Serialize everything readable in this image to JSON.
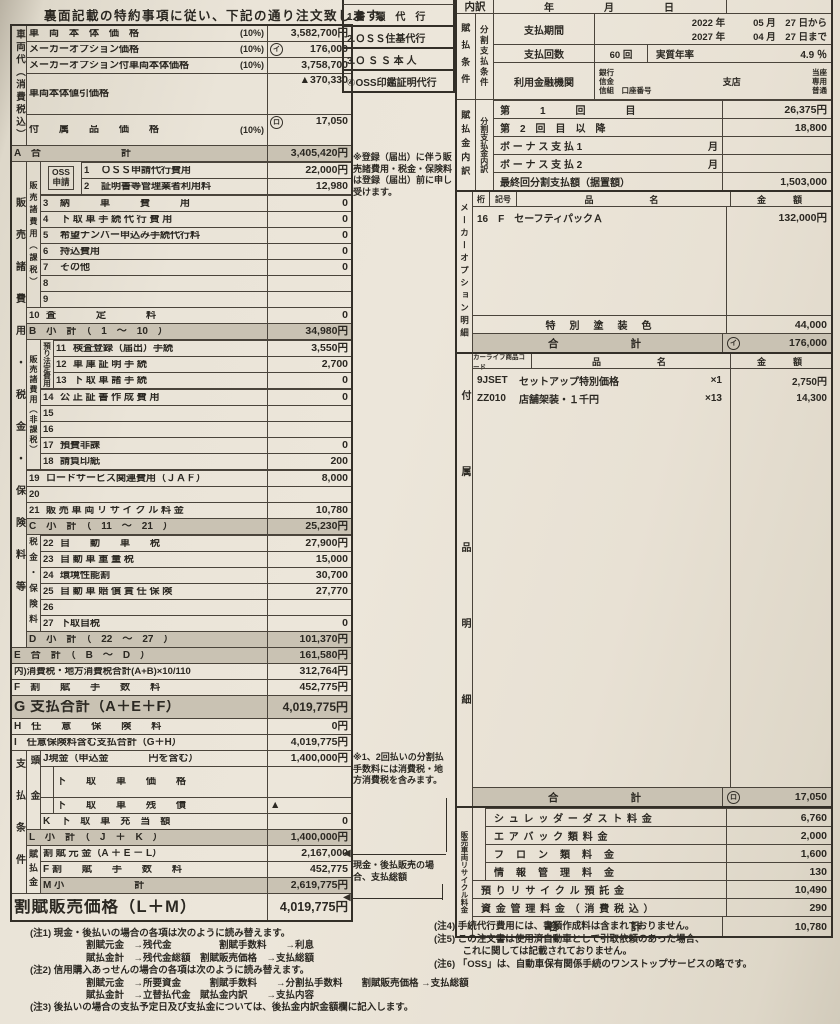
{
  "page": {
    "header_note": "裏面記載の特約事項に従い、下記の通り注文致します。"
  },
  "left": {
    "strip_vehicle": "車両代（消費税込）",
    "strip_sales": "販売諸費用・税金・保険料等",
    "strip_payment": "支払条件",
    "vehicle": {
      "r1": {
        "label": "車　両　本　体　価　格",
        "pct": "(10%)",
        "value": "3,582,700円"
      },
      "r2": {
        "label": "メーカーオプション価格",
        "pct": "(10%)",
        "mark": "イ",
        "value": "176,000"
      },
      "r3": {
        "label": "メーカーオプション付車両本体価格",
        "pct": "(10%)",
        "value": "3,758,700"
      },
      "r4": {
        "label": "車両本体値引価格",
        "value": "▲370,330"
      },
      "r5": {
        "label": "付　　属　　品　　価　　格",
        "pct": "(10%)",
        "mark": "ロ",
        "value": "17,050"
      }
    },
    "subA": {
      "label": "A　合　　　　　　　　計",
      "value": "3,405,420円"
    },
    "oss_box": "OSS\n申請",
    "strip_taxable": "販売諸費用（課税）",
    "oss_rows": [
      {
        "num": "1",
        "label": "ＯＳＳ申請代行費用",
        "value": "22,000円"
      },
      {
        "num": "2",
        "label": "証明書等管理業者利用料",
        "value": "12,980"
      }
    ],
    "taxable_rows": [
      {
        "num": "3",
        "label": "納　　　車　　　費　　　用",
        "value": "0"
      },
      {
        "num": "4",
        "label": "下 取 車 手 続 代 行 費 用",
        "value": "0"
      },
      {
        "num": "5",
        "label": "希望ナンバー申込み手続代行料",
        "value": "0"
      },
      {
        "num": "6",
        "label": "持込費用",
        "value": "0"
      },
      {
        "num": "7",
        "label": "その他",
        "value": "0"
      },
      {
        "num": "8",
        "label": "",
        "value": ""
      },
      {
        "num": "9",
        "label": "",
        "value": ""
      }
    ],
    "row10": {
      "num": "10",
      "label": "査　　　　定　　　　料",
      "value": "0"
    },
    "subB": {
      "label": "B　小　計　（　1　～　10　）",
      "value": "34,980円"
    },
    "strip_nontax": "販売諸費用（非課税）",
    "strip_deposit": "預り法定費用",
    "deposit_rows": [
      {
        "num": "11",
        "label": "検査登録（届出）手続",
        "value": "3,550円"
      },
      {
        "num": "12",
        "label": "車 庫 証 明 手 続",
        "value": "2,700"
      },
      {
        "num": "13",
        "label": "下 取 車 諸 手 続",
        "value": "0"
      }
    ],
    "nontax_rows": [
      {
        "num": "14",
        "label": "公 正 証 書 作 成 費 用",
        "value": "0"
      },
      {
        "num": "15",
        "label": "",
        "value": ""
      },
      {
        "num": "16",
        "label": "",
        "value": ""
      },
      {
        "num": "17",
        "label": "預費非課",
        "value": "0"
      },
      {
        "num": "18",
        "label": "請負印紙",
        "value": "200"
      }
    ],
    "wide_rows": [
      {
        "num": "19",
        "label": "ロードサービス関連費用（ＪＡＦ）",
        "value": "8,000"
      },
      {
        "num": "20",
        "label": "",
        "value": ""
      },
      {
        "num": "21",
        "label": "販 売 車 両 リ サ イ ク ル 料 金",
        "value": "10,780"
      }
    ],
    "subC": {
      "label": "C　小　計　（　11　～　21　）",
      "value": "25,230円"
    },
    "strip_tax": "税金・保険料",
    "tax_rows": [
      {
        "num": "22",
        "label": "自　　動　　車　　税",
        "value": "27,900円"
      },
      {
        "num": "23",
        "label": "自 動 車 重 量 税",
        "value": "15,000"
      },
      {
        "num": "24",
        "label": "環境性能割",
        "value": "30,700"
      },
      {
        "num": "25",
        "label": "自 動 車 賠 償 責 任 保 険",
        "value": "27,770"
      },
      {
        "num": "26",
        "label": "",
        "value": ""
      },
      {
        "num": "27",
        "label": "下取自税",
        "value": "0"
      }
    ],
    "subD": {
      "label": "D　小　計　（　22　～　27　）",
      "value": "101,370円"
    },
    "subE": {
      "label": "E　合　計　（　B　～　D　）",
      "value": "161,580円"
    },
    "rowTax": {
      "label": "内)消費税・地方消費税合計(A+B)×10/110",
      "value": "312,764円"
    },
    "rowF": {
      "label": "F　割　　賦　　手　　数　　料",
      "value": "452,775円"
    },
    "rowG": {
      "label": "G 支払合計（A＋E＋F）",
      "value": "4,019,775円"
    },
    "rowH": {
      "label": "H　任　　意　　保　　険　　料",
      "value": "0円"
    },
    "rowI": {
      "label": "I　任意保険料含む支払合計（G＋H）",
      "value": "4,019,775円"
    },
    "strip_down": "頭金",
    "rowJ": {
      "label": "J現金（申込金　　　　円を含む）",
      "value": "1,400,000円"
    },
    "trade_price": {
      "label": "下　　取　　車　　価　　格",
      "value": ""
    },
    "trade_debt": {
      "label": "下　　取　　車　　残　　債",
      "value": "▲"
    },
    "rowK": {
      "label": "K　下　取　車　充　当　額",
      "value": "0"
    },
    "subL": {
      "label": "L　小　計　（　J　＋　K　）",
      "value": "1,400,000円"
    },
    "strip_install": "賦払金",
    "rowGenkin": {
      "label": "割 賦 元 金（A ＋ E － L）",
      "value": "2,167,000"
    },
    "rowF2": {
      "label": "F 割　　賦　　手　　数　　料",
      "value": "452,775"
    },
    "subM": {
      "label": "M 小　　　　　　　計",
      "value": "2,619,775円"
    },
    "final": {
      "label": "割賦販売価格（L＋M）",
      "value": "4,019,775円"
    }
  },
  "side_notes": {
    "registration": "※登録（届出）に伴う販売諸費用・税金・保険料は登録（届出）前に申し受けます。",
    "split": "※1、2回払いの分割払手数料には消費税・地方消費税を含みます。",
    "cash": "現金・後払販売の場合、支払総額"
  },
  "middle_list": {
    "items": [
      {
        "label": "1.書　類　代　行"
      },
      {
        "label": "2.ＯＳＳ住基代行"
      },
      {
        "label": "3.Ｏ Ｓ Ｓ 本 人"
      },
      {
        "label": "④OSS印鑑証明代行"
      }
    ]
  },
  "right": {
    "breakdown_label": "内訳",
    "date_row": "年　　　　月　　　　日",
    "strip_pay1": "賦払条件",
    "strip_pay2": "分割支払条件",
    "pay_period_label": "支払期間",
    "from_year": "2022 年",
    "from_md": "05 月　27 日から",
    "to_year": "2027 年",
    "to_md": "04 月　27 日まで",
    "pay_count_label": "支払回数",
    "pay_count": "60 回",
    "rate_label": "実質年率",
    "rate": "4.9 ％",
    "bank_label": "利用金融機関",
    "bank1": "銀行",
    "bank2": "信金",
    "bank3": "信組　口座番号",
    "branch": "支店",
    "acct1": "当座",
    "acct2": "専用",
    "acct3": "普通",
    "strip_bd1": "賦払金内訳",
    "strip_bd2": "分割支払金内訳",
    "installment_rows": [
      {
        "label": "第　　　1　　　回　　　　目",
        "suffix": "",
        "value": "26,375円"
      },
      {
        "label": "第　2　回　目　以　降",
        "suffix": "",
        "value": "18,800"
      },
      {
        "label": "ボ ー ナ ス 支 払 1",
        "suffix": "月",
        "value": ""
      },
      {
        "label": "ボ ー ナ ス 支 払 2",
        "suffix": "月",
        "value": ""
      },
      {
        "label": "最終回分割支払額（据置額）",
        "suffix": "",
        "value": "1,503,000"
      }
    ],
    "maker": {
      "strip": "メーカーオプション明細",
      "h_c1": "桁",
      "h_c2": "記号",
      "h_name": "品　　　　名",
      "h_amount": "金　　額",
      "row": {
        "c1": "16",
        "c2": "F",
        "name": "セーフティパックＡ",
        "amount": "132,000円"
      },
      "special": {
        "label": "特　別　塗　装　色",
        "value": "44,000"
      },
      "total": {
        "label": "合　　　　計",
        "mark": "イ",
        "value": "176,000"
      }
    },
    "accessory": {
      "strip": "付属品明細",
      "h_code": "カーライフ商品コード",
      "h_name": "品　　　　名",
      "h_amount": "金　　額",
      "rows": [
        {
          "code": "9JSET",
          "name": "セットアップ特別価格",
          "qty": "×1",
          "amount": "2,750円"
        },
        {
          "code": "ZZ010",
          "name": "店舗架装・１千円",
          "qty": "×13",
          "amount": "14,300"
        }
      ],
      "total": {
        "label": "合　　　　計",
        "mark": "ロ",
        "value": "17,050"
      }
    },
    "recycle": {
      "strip": "販売車両リサイクル料金",
      "inner_rows": [
        {
          "label": "シ ュ レ ッ ダ ー ダ ス ト 料 金",
          "value": "6,760"
        },
        {
          "label": "エ ア バ ッ ク 類 料 金",
          "value": "2,000"
        },
        {
          "label": "フ　ロ　ン　類　料　金",
          "value": "1,600"
        },
        {
          "label": "情　報　管　理　料　金",
          "value": "130"
        }
      ],
      "deposit": {
        "label": "預 り リ サ イ ク ル 預 託 金",
        "value": "10,490"
      },
      "mgmt": {
        "label": "資 金 管 理 料 金 （ 消 費 税 込 ）",
        "value": "290"
      },
      "total": {
        "label": "合　　　　計",
        "value": "10,780"
      }
    },
    "notes": [
      "(注4) 手続代行費用には、書類作成料は含まれておりません。",
      "(注5) この注文書は使用済自動車として引取依頼のあった場合、",
      "　　　これに関しては記載されておりません。",
      "(注6) 「OSS」は、自動車保有関係手続のワンストップサービスの略です。"
    ]
  },
  "bottom_notes": {
    "n1": "(注1) 現金・後払いの場合の各項は次のように読み替えます。",
    "n1a": "割賦元金　→残代金　　　　　割賦手数料　　→利息",
    "n1b": "賦払金計　→残代金総額　割賦販売価格　→支払総額",
    "n2": "(注2) 信用購入あっせんの場合の各項は次のように読み替えます。",
    "n2a": "割賦元金　→所要資金　　　割賦手数料　　→分割払手数料　　割賦販売価格 →支払総額",
    "n2b": "賦払金計　→立替払代金　賦払金内訳　　→支払内容",
    "n3": "(注3) 後払いの場合の支払予定日及び支払金については、後払金内訳金額欄に記入します。"
  }
}
